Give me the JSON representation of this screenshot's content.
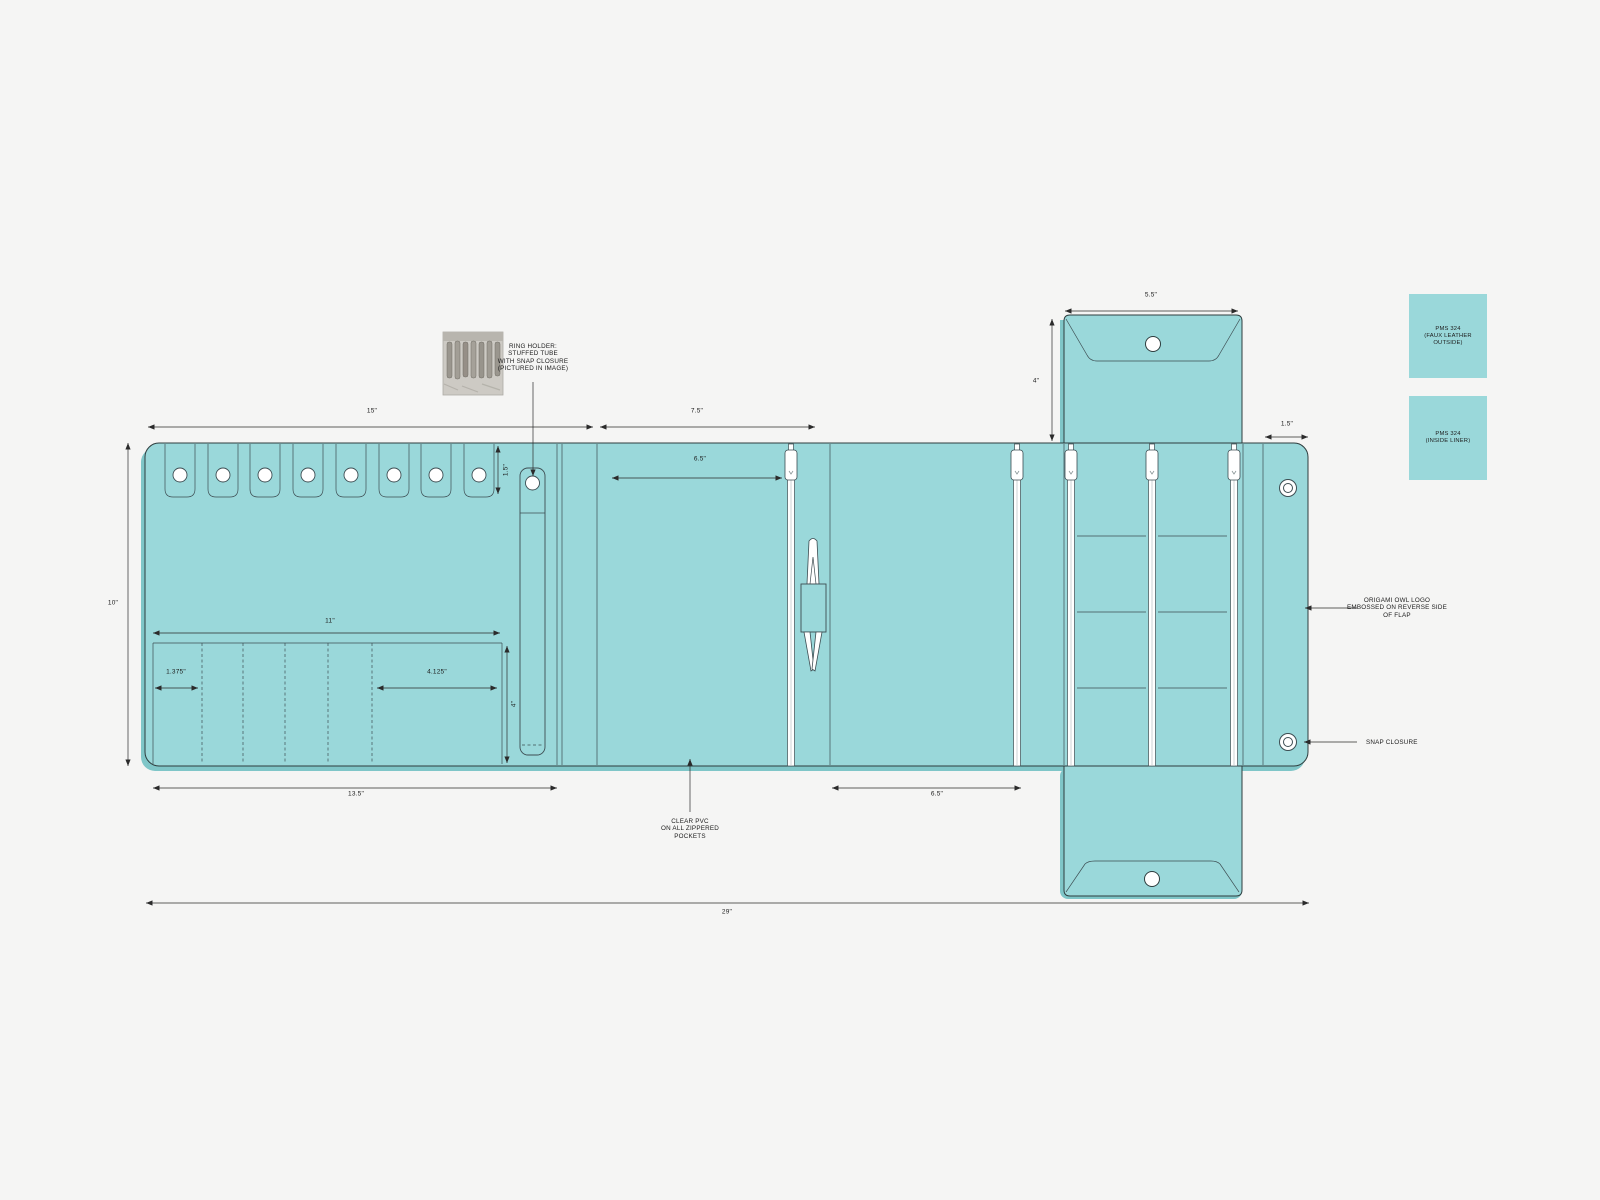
{
  "document": {
    "type": "product-spec-drawing",
    "subject": "fold-out jewelry organizer roll"
  },
  "colors": {
    "teal": "#9ad8da",
    "teal_shadow": "#7fc6c8",
    "outline": "#2e3d3e",
    "background": "#f5f5f4",
    "white": "#ffffff"
  },
  "dimensions": {
    "panel_left_width": "15\"",
    "panel_mid_width": "7.5\"",
    "panel_height": "10\"",
    "tab_height": "1.5\"",
    "pocket_row_width": "11\"",
    "pocket_small_width": "1.375\"",
    "pocket_large_width": "4.125\"",
    "pocket_height": "4\"",
    "left_panel_bottom_width": "13.5\"",
    "zip_pocket_top_width": "6.5\"",
    "zip_pocket_bottom_width": "6.5\"",
    "total_width": "29\"",
    "flap_width": "5.5\"",
    "flap_height": "4\"",
    "end_flap_width": "1.5\""
  },
  "annotations": {
    "ring_holder": {
      "line1": "RING HOLDER:",
      "line2": "STUFFED TUBE",
      "line3": "WITH SNAP CLOSURE",
      "line4": "(PICTURED IN IMAGE)"
    },
    "clear_pvc": {
      "line1": "CLEAR PVC",
      "line2": "ON ALL ZIPPERED",
      "line3": "POCKETS"
    },
    "logo": {
      "line1": "ORIGAMI OWL LOGO",
      "line2": "EMBOSSED ON REVERSE SIDE",
      "line3": "OF FLAP"
    },
    "snap": "SNAP CLOSURE"
  },
  "swatches": {
    "outside": {
      "line1": "PMS 324",
      "line2": "(FAUX LEATHER OUTSIDE)",
      "color": "#9ad8da"
    },
    "liner": {
      "line1": "PMS 324",
      "line2": "(INSIDE LINER)",
      "color": "#9ad8da"
    }
  }
}
